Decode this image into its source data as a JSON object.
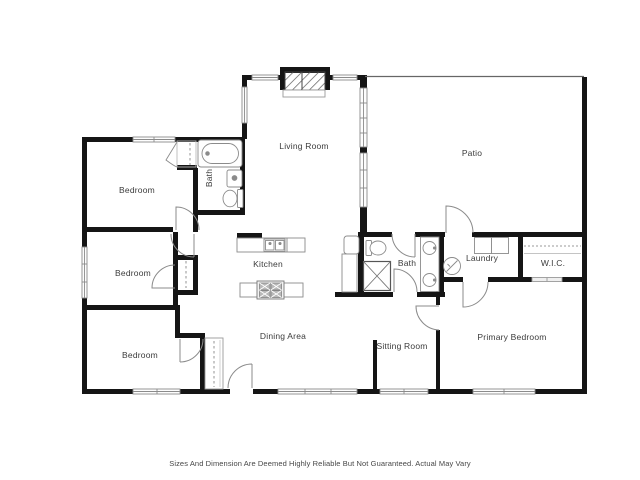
{
  "disclaimer": "Sizes And Dimension Are Deemed Highly Reliable But Not Guaranteed. Actual May Vary",
  "rooms": [
    {
      "id": "living-room",
      "label": "Living Room"
    },
    {
      "id": "patio",
      "label": "Patio"
    },
    {
      "id": "bedroom-1",
      "label": "Bedroom"
    },
    {
      "id": "bath-1",
      "label": "Bath"
    },
    {
      "id": "bedroom-2",
      "label": "Bedroom"
    },
    {
      "id": "kitchen",
      "label": "Kitchen"
    },
    {
      "id": "bath-2",
      "label": "Bath"
    },
    {
      "id": "laundry",
      "label": "Laundry"
    },
    {
      "id": "wic",
      "label": "W.I.C."
    },
    {
      "id": "bedroom-3",
      "label": "Bedroom"
    },
    {
      "id": "dining-area",
      "label": "Dining Area"
    },
    {
      "id": "sitting-room",
      "label": "Sitting Room"
    },
    {
      "id": "primary-bedroom",
      "label": "Primary Bedroom"
    }
  ],
  "fixtures": [
    "bathtub",
    "sink",
    "toilet",
    "shower",
    "stove",
    "kitchen-sink",
    "refrigerator",
    "washer",
    "dryer",
    "fireplace",
    "closet-rod",
    "bifold-door"
  ],
  "colors": {
    "walls": "#151515",
    "fixtures": "#8b8b8b",
    "labels": "#3b3b3b",
    "background": "#ffffff"
  }
}
